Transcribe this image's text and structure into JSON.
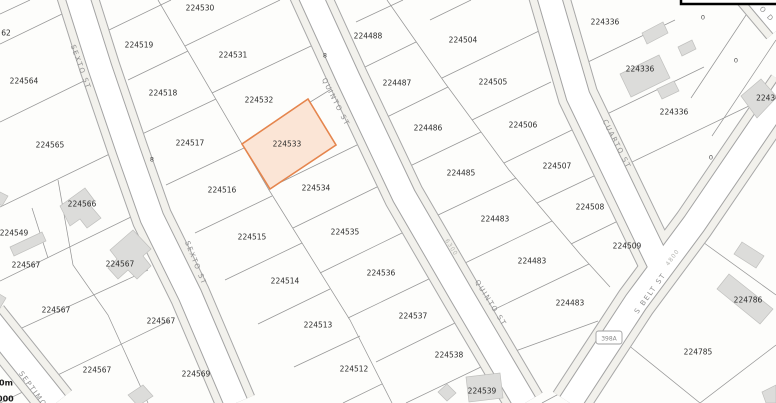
{
  "map": {
    "background": "#fdfdfb",
    "selected_parcel": {
      "id": "224533",
      "fill": "#fbe5d6",
      "stroke": "#e5854d"
    },
    "parcel_labels": [
      {
        "id": "62",
        "x": 6,
        "y": 33
      },
      {
        "id": "224564",
        "x": 24,
        "y": 81
      },
      {
        "id": "224565",
        "x": 50,
        "y": 145
      },
      {
        "id": "224566",
        "x": 82,
        "y": 204
      },
      {
        "id": "224549",
        "x": 14,
        "y": 233
      },
      {
        "id": "224567",
        "x": 26,
        "y": 265
      },
      {
        "id": "224567",
        "x": 120,
        "y": 264
      },
      {
        "id": "224567",
        "x": 56,
        "y": 310
      },
      {
        "id": "224567",
        "x": 161,
        "y": 321
      },
      {
        "id": "224567",
        "x": 97,
        "y": 370
      },
      {
        "id": "224569",
        "x": 196,
        "y": 374
      },
      {
        "id": "224519",
        "x": 139,
        "y": 45
      },
      {
        "id": "224518",
        "x": 163,
        "y": 93
      },
      {
        "id": "224517",
        "x": 190,
        "y": 143
      },
      {
        "id": "224516",
        "x": 222,
        "y": 190
      },
      {
        "id": "224515",
        "x": 252,
        "y": 237
      },
      {
        "id": "224514",
        "x": 285,
        "y": 281
      },
      {
        "id": "224513",
        "x": 318,
        "y": 325
      },
      {
        "id": "224512",
        "x": 354,
        "y": 369
      },
      {
        "id": "224530",
        "x": 200,
        "y": 8
      },
      {
        "id": "224531",
        "x": 233,
        "y": 55
      },
      {
        "id": "224532",
        "x": 259,
        "y": 100
      },
      {
        "id": "224533",
        "x": 287,
        "y": 144
      },
      {
        "id": "224534",
        "x": 316,
        "y": 188
      },
      {
        "id": "224535",
        "x": 345,
        "y": 232
      },
      {
        "id": "224536",
        "x": 381,
        "y": 273
      },
      {
        "id": "224537",
        "x": 413,
        "y": 316
      },
      {
        "id": "224538",
        "x": 449,
        "y": 355
      },
      {
        "id": "224539",
        "x": 482,
        "y": 391
      },
      {
        "id": "224488",
        "x": 368,
        "y": 36
      },
      {
        "id": "224487",
        "x": 397,
        "y": 83
      },
      {
        "id": "224486",
        "x": 428,
        "y": 128
      },
      {
        "id": "224485",
        "x": 461,
        "y": 173
      },
      {
        "id": "224483",
        "x": 495,
        "y": 219
      },
      {
        "id": "224483",
        "x": 532,
        "y": 261
      },
      {
        "id": "224483",
        "x": 570,
        "y": 303
      },
      {
        "id": "224504",
        "x": 463,
        "y": 40
      },
      {
        "id": "224505",
        "x": 493,
        "y": 82
      },
      {
        "id": "224506",
        "x": 523,
        "y": 125
      },
      {
        "id": "224507",
        "x": 557,
        "y": 166
      },
      {
        "id": "224508",
        "x": 590,
        "y": 207
      },
      {
        "id": "224509",
        "x": 627,
        "y": 246
      },
      {
        "id": "224336",
        "x": 605,
        "y": 22
      },
      {
        "id": "224336",
        "x": 640,
        "y": 69
      },
      {
        "id": "224336",
        "x": 674,
        "y": 112
      },
      {
        "id": "22436",
        "x": 768,
        "y": 98
      },
      {
        "id": "224786",
        "x": 748,
        "y": 300
      },
      {
        "id": "224785",
        "x": 698,
        "y": 352
      }
    ],
    "small_labels": [
      {
        "text": "0",
        "x": 703,
        "y": 17
      },
      {
        "text": "0",
        "x": 736,
        "y": 60
      },
      {
        "text": "0",
        "x": 711,
        "y": 157
      },
      {
        "text": "8",
        "x": 152,
        "y": 159
      },
      {
        "text": "8",
        "x": 325,
        "y": 55
      }
    ],
    "street_labels": [
      {
        "name": "SEXTO ST",
        "x": 81,
        "y": 67,
        "rot": 70
      },
      {
        "name": "SEXTO ST",
        "x": 196,
        "y": 263,
        "rot": 68
      },
      {
        "name": "SEPTIMO",
        "x": 33,
        "y": 389,
        "rot": 54
      },
      {
        "name": "QUINTO ST",
        "x": 336,
        "y": 102,
        "rot": 63
      },
      {
        "name": "QUINTO ST",
        "x": 491,
        "y": 303,
        "rot": 58
      },
      {
        "name": "CUARTO ST",
        "x": 617,
        "y": 144,
        "rot": 63
      },
      {
        "name": "S BELT ST",
        "x": 650,
        "y": 293,
        "rot": -54
      },
      {
        "name": "O D",
        "x": 767,
        "y": 14,
        "rot": 48
      }
    ],
    "address_labels": [
      {
        "text": "6300",
        "x": 452,
        "y": 247,
        "rot": 58
      },
      {
        "text": "4800",
        "x": 672,
        "y": 257,
        "rot": -54
      }
    ],
    "route_shield": {
      "text": "398A",
      "x": 609,
      "y": 338
    },
    "scale_fragments": [
      {
        "text": "0m",
        "x": -1,
        "y": 383
      },
      {
        "text": "000",
        "x": -3,
        "y": 399
      }
    ]
  }
}
